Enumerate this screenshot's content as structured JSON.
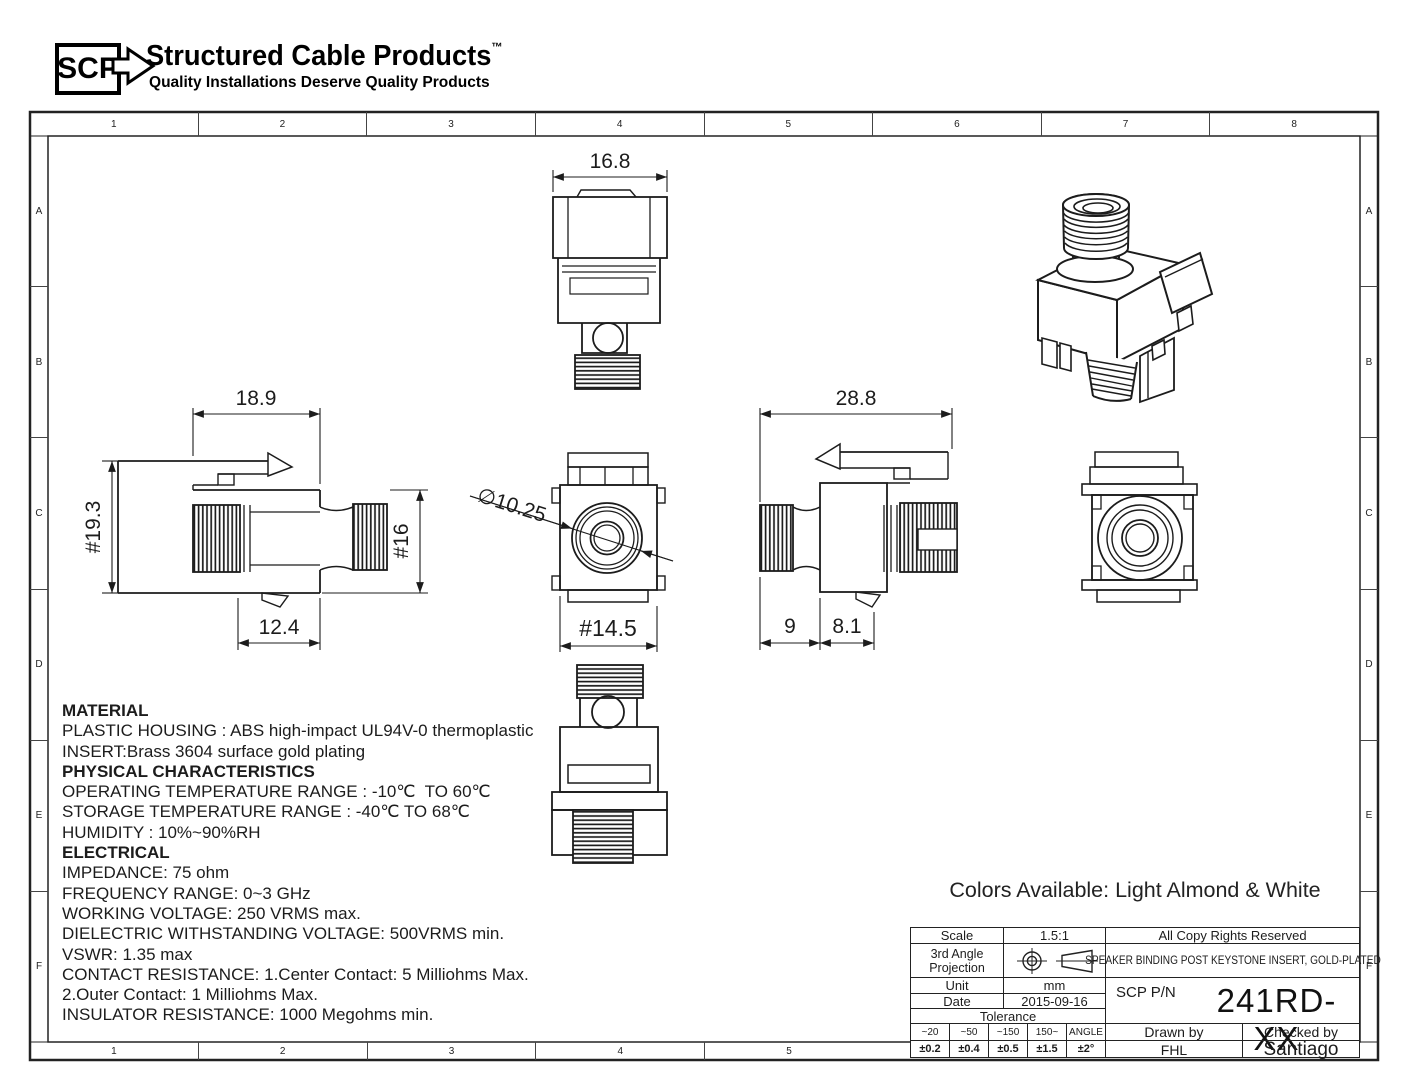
{
  "logo": {
    "abbr": "SCP",
    "title": "Structured Cable Products",
    "trademark": "TM",
    "tagline": "Quality Installations Deserve Quality Products"
  },
  "frame": {
    "columns": [
      "1",
      "2",
      "3",
      "4",
      "5",
      "6",
      "7",
      "8"
    ],
    "bottom_columns": [
      "1",
      "2",
      "3",
      "4",
      "5"
    ],
    "rows": [
      "A",
      "B",
      "C",
      "D",
      "E",
      "F"
    ]
  },
  "views": {
    "front_top": {
      "width": "16.8"
    },
    "side_left": {
      "width": "18.9",
      "overall_height": "#19.3",
      "body_height": "#16",
      "nose_depth": "12.4"
    },
    "face_front": {
      "bore_diameter": "∅10.25",
      "body_width": "#14.5"
    },
    "side_right": {
      "overall_depth": "28.8",
      "connector_length": "9",
      "nose_length": "8.1"
    }
  },
  "notes": [
    {
      "text": "MATERIAL",
      "bold": true
    },
    {
      "text": "PLASTIC HOUSING : ABS high-impact UL94V-0 thermoplastic",
      "bold": false
    },
    {
      "text": "INSERT:Brass 3604 surface gold plating",
      "bold": false
    },
    {
      "text": "PHYSICAL CHARACTERISTICS",
      "bold": true
    },
    {
      "text": "OPERATING TEMPERATURE RANGE : -10℃  TO 60℃",
      "bold": false
    },
    {
      "text": "STORAGE TEMPERATURE RANGE : -40℃ TO 68℃",
      "bold": false
    },
    {
      "text": "HUMIDITY : 10%~90%RH",
      "bold": false
    },
    {
      "text": "ELECTRICAL",
      "bold": true
    },
    {
      "text": "IMPEDANCE: 75 ohm",
      "bold": false
    },
    {
      "text": "FREQUENCY RANGE: 0~3 GHz",
      "bold": false
    },
    {
      "text": "WORKING VOLTAGE: 250 VRMS max.",
      "bold": false
    },
    {
      "text": "DIELECTRIC WITHSTANDING VOLTAGE: 500VRMS min.",
      "bold": false
    },
    {
      "text": "VSWR: 1.35 max",
      "bold": false
    },
    {
      "text": "CONTACT RESISTANCE: 1.Center Contact: 5 Milliohms Max.",
      "bold": false
    },
    {
      "text": "2.Outer Contact: 1 Milliohms Max.",
      "bold": false
    },
    {
      "text": "INSULATOR RESISTANCE: 1000 Megohms min.",
      "bold": false
    }
  ],
  "colors_note": "Colors Available: Light Almond & White",
  "title_block": {
    "scale_label": "Scale",
    "scale_value": "1.5:1",
    "copyright": "All Copy Rights Reserved",
    "projection_label_1": "3rd Angle",
    "projection_label_2": "Projection",
    "product_title": "SPEAKER BINDING POST KEYSTONE INSERT, GOLD-PLATED",
    "unit_label": "Unit",
    "unit_value": "mm",
    "pn_label": "SCP P/N",
    "pn_value": "241RD-XX",
    "date_label": "Date",
    "date_value": "2015-09-16",
    "tolerance_label": "Tolerance",
    "tolerance_headers": [
      "~20",
      "~50",
      "~150",
      "150~",
      "ANGLE"
    ],
    "tolerance_values": [
      "±0.2",
      "±0.4",
      "±0.5",
      "±1.5",
      "±2°"
    ],
    "drawn_by_label": "Drawn by",
    "drawn_by_value": "FHL",
    "checked_by_label": "Checked by",
    "checked_by_value": "Santiago"
  },
  "colors": {
    "ink": "#1c1c1c",
    "background": "#ffffff"
  }
}
